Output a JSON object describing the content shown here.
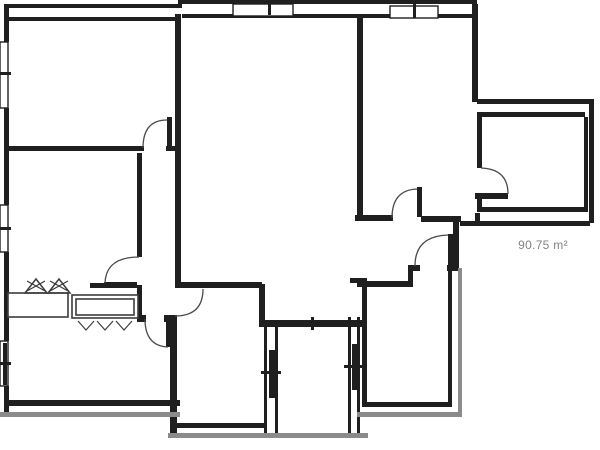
{
  "area_label": {
    "text": "90.75 m²"
  },
  "floorplan": {
    "colors": {
      "wall": "#1f1f1f",
      "outer": "#8b8b8b",
      "arc": "#4a4a4a",
      "fixture": "#3c3c3c",
      "bg": "#ffffff"
    },
    "walls": [
      [
        8,
        4,
        174,
        4
      ],
      [
        178,
        0,
        4,
        8
      ],
      [
        180,
        0,
        297,
        4
      ],
      [
        4,
        4,
        5,
        38
      ],
      [
        4,
        108,
        5,
        97
      ],
      [
        4,
        252,
        5,
        89
      ],
      [
        4,
        386,
        5,
        28
      ],
      [
        8,
        17,
        170,
        4
      ],
      [
        175,
        14,
        6,
        271
      ],
      [
        182,
        14,
        178,
        4
      ],
      [
        357,
        14,
        6,
        203
      ],
      [
        363,
        14,
        110,
        4
      ],
      [
        472,
        4,
        6,
        98
      ],
      [
        477,
        99,
        117,
        5
      ],
      [
        589,
        102,
        5,
        121
      ],
      [
        460,
        221,
        130,
        5
      ],
      [
        477,
        112,
        5,
        56
      ],
      [
        482,
        112,
        103,
        5
      ],
      [
        584,
        117,
        4,
        95
      ],
      [
        482,
        207,
        102,
        5
      ],
      [
        477,
        196,
        5,
        16
      ],
      [
        475,
        213,
        5,
        10
      ],
      [
        8,
        146,
        136,
        5
      ],
      [
        166,
        146,
        12,
        5
      ],
      [
        137,
        153,
        5,
        104
      ],
      [
        137,
        285,
        5,
        37
      ],
      [
        90,
        283,
        47,
        5
      ],
      [
        175,
        282,
        87,
        6
      ],
      [
        259,
        284,
        6,
        43
      ],
      [
        259,
        320,
        103,
        7
      ],
      [
        170,
        316,
        7,
        117
      ],
      [
        177,
        423,
        88,
        5
      ],
      [
        140,
        315,
        6,
        7
      ],
      [
        164,
        315,
        13,
        7
      ],
      [
        264,
        327,
        3,
        106
      ],
      [
        275,
        327,
        3,
        106
      ],
      [
        348,
        317,
        3,
        116
      ],
      [
        357,
        317,
        3,
        116
      ],
      [
        357,
        281,
        56,
        6
      ],
      [
        408,
        265,
        5,
        22
      ],
      [
        413,
        265,
        7,
        6
      ],
      [
        447,
        265,
        12,
        6
      ],
      [
        453,
        222,
        6,
        47
      ],
      [
        421,
        216,
        40,
        6
      ],
      [
        355,
        215,
        38,
        6
      ],
      [
        362,
        278,
        5,
        129
      ],
      [
        350,
        278,
        17,
        5
      ],
      [
        367,
        402,
        85,
        5
      ],
      [
        448,
        268,
        4,
        139
      ],
      [
        8,
        400,
        172,
        6
      ]
    ],
    "outer_lines": [
      [
        0,
        412,
        180,
        5
      ],
      [
        168,
        433,
        200,
        5
      ],
      [
        357,
        412,
        103,
        5
      ],
      [
        458,
        268,
        4,
        149
      ]
    ],
    "door_leaves": [
      [
        167,
        117,
        5,
        32
      ],
      [
        104,
        282,
        33,
        5
      ],
      [
        417,
        187,
        5,
        30
      ],
      [
        475,
        193,
        33,
        6
      ],
      [
        448,
        234,
        5,
        33
      ],
      [
        166,
        320,
        5,
        27
      ]
    ],
    "door_arcs": [
      "M 143 148 Q 143 120 167 120",
      "M 139 257 Q 106 257 105 283",
      "M 392 218 Q 392 190 417 189",
      "M 481 168 Q 508 169 508 194",
      "M 415 266 Q 415 236 448 235",
      "M 145 319 Q 145 346 168 347",
      "M 175 316 Q 203 316 203 289"
    ],
    "window_boxes": [
      [
        0,
        42,
        8,
        66
      ],
      [
        0,
        205,
        8,
        47
      ],
      [
        0,
        341,
        8,
        45
      ],
      [
        233,
        4,
        60,
        12
      ],
      [
        390,
        6,
        48,
        12
      ]
    ],
    "window_bars": [
      [
        3,
        343,
        4,
        42
      ],
      [
        269,
        350,
        6,
        48
      ],
      [
        352,
        344,
        5,
        46
      ]
    ],
    "ticks": [
      [
        0,
        72,
        11,
        3
      ],
      [
        0,
        227,
        11,
        3
      ],
      [
        0,
        362,
        11,
        3
      ],
      [
        268,
        1,
        3,
        14
      ],
      [
        413,
        4,
        3,
        14
      ],
      [
        311,
        317,
        3,
        13
      ],
      [
        261,
        371,
        20,
        3
      ],
      [
        344,
        365,
        20,
        3
      ]
    ],
    "counter_boxes": [
      [
        8,
        293,
        60,
        24
      ],
      [
        72,
        295,
        66,
        23
      ],
      [
        76,
        299,
        58,
        16
      ]
    ],
    "triangles": [
      [
        25,
        293,
        47,
        293,
        36,
        279
      ],
      [
        48,
        293,
        70,
        293,
        59,
        279
      ]
    ],
    "fixture_lines": [
      [
        27,
        291,
        45,
        281
      ],
      [
        27,
        281,
        45,
        291
      ],
      [
        50,
        291,
        68,
        281
      ],
      [
        50,
        281,
        68,
        291
      ]
    ],
    "vmarks": [
      [
        78,
        321,
        86,
        330,
        94,
        321
      ],
      [
        97,
        321,
        105,
        330,
        113,
        321
      ],
      [
        116,
        321,
        124,
        330,
        132,
        321
      ]
    ]
  }
}
